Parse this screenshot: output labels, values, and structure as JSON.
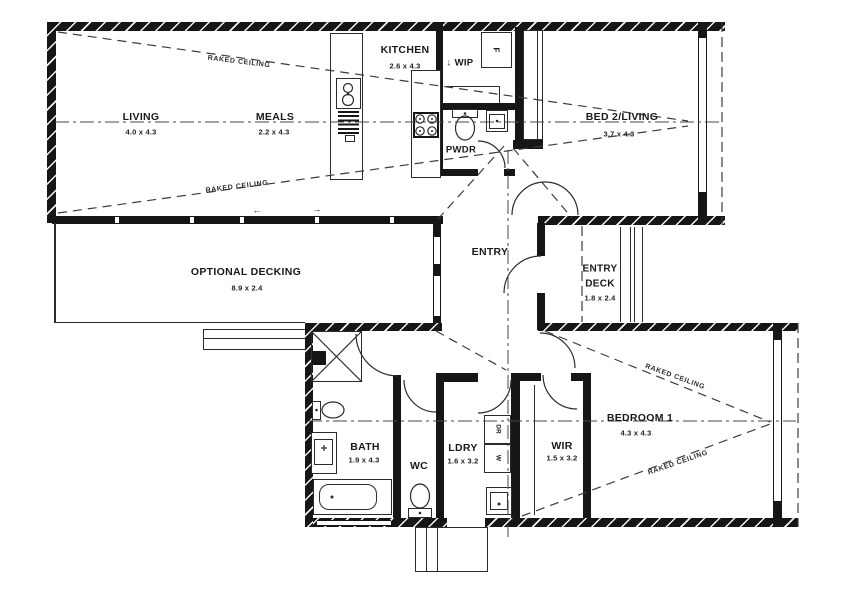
{
  "rooms": {
    "living": {
      "name": "LIVING",
      "dims": "4.0 x 4.3"
    },
    "meals": {
      "name": "MEALS",
      "dims": "2.2 x 4.3"
    },
    "kitchen": {
      "name": "KITCHEN",
      "dims": "2.6 x 4.3"
    },
    "wip": {
      "name": "↓ WIP"
    },
    "pwdr": {
      "name": "PWDR"
    },
    "bed2": {
      "name": "BED 2/LIVING",
      "dims": "3.7 x 4.3"
    },
    "entry": {
      "name": "ENTRY"
    },
    "entry_deck": {
      "line1": "ENTRY",
      "line2": "DECK",
      "dims": "1.8 x 2.4"
    },
    "optional_decking": {
      "name": "OPTIONAL DECKING",
      "dims": "8.9 x 2.4"
    },
    "bath": {
      "name": "BATH",
      "dims": "1.9 x 4.3"
    },
    "wc": {
      "name": "WC"
    },
    "ldry": {
      "name": "LDRY",
      "dims": "1.6 x 3.2"
    },
    "wir": {
      "name": "WIR",
      "dims": "1.5 x 3.2"
    },
    "bedroom1": {
      "name": "BEDROOM 1",
      "dims": "4.3 x 4.3"
    }
  },
  "annotations": {
    "raked_ceiling": "RAKED CEILING"
  },
  "appliances": {
    "fridge": "F",
    "dryer": "DR",
    "washer": "W"
  },
  "icons": {
    "slide_arrow_left": "←",
    "slide_arrow_right": "→"
  },
  "colors": {
    "wall": "#161616",
    "line": "#2b2b2b",
    "dashed": "#3c3c3c",
    "background": "#ffffff"
  }
}
